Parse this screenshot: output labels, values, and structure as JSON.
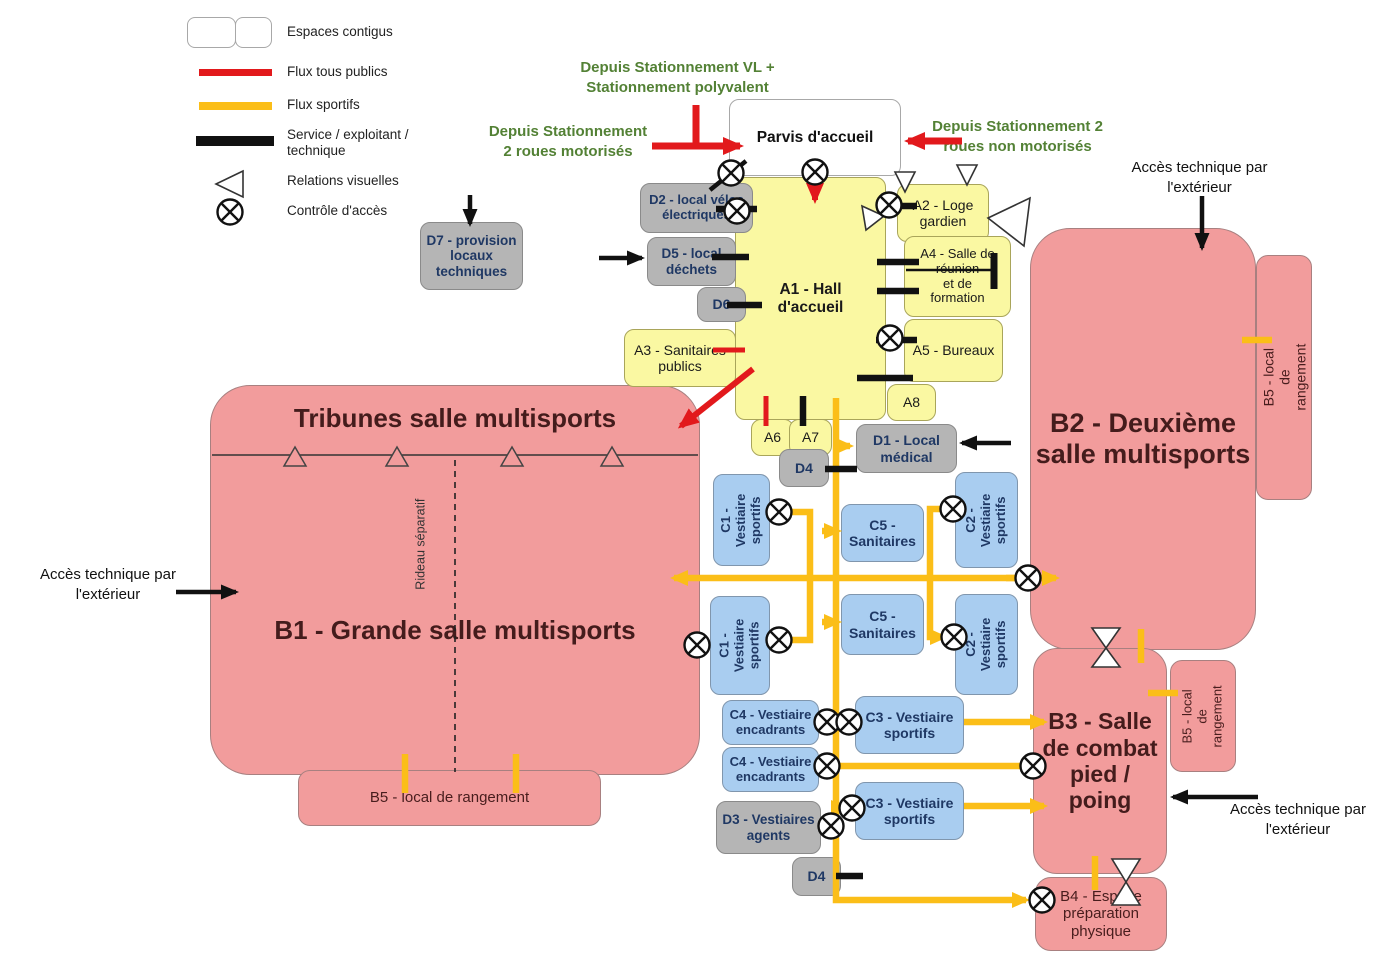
{
  "legend": {
    "espaces_contigus": "Espaces contigus",
    "flux_tous_publics": "Flux tous publics",
    "flux_sportifs": "Flux sportifs",
    "service": "Service / exploitant /\ntechnique",
    "relations_visuelles": "Relations visuelles",
    "controle_acces": "Contrôle d'accès"
  },
  "external_flows": {
    "depuis_vl": "Depuis Stationnement VL +\nStationnement polyvalent",
    "depuis_2r_motorises": "Depuis Stationnement\n2 roues motorisés",
    "depuis_2r_non_motorises": "Depuis Stationnement 2\nroues non motorisés",
    "acces_technique": "Accès technique par\nl'extérieur"
  },
  "annotations": {
    "tribunes": "Tribunes salle multisports",
    "rideau_separatif": "Rideau séparatif"
  },
  "nodes": {
    "parvis": "Parvis d'accueil",
    "a1": "A1 - Hall\nd'accueil",
    "a2": "A2 - Loge\ngardien",
    "a3": "A3 - Sanitaires\npublics",
    "a4": "A4 - Salle de\nréunion\net de\nformation",
    "a5": "A5 - Bureaux",
    "a6": "A6",
    "a7": "A7",
    "a8": "A8",
    "b1": "B1 - Grande salle multisports",
    "b2": "B2 - Deuxième\nsalle multisports",
    "b3": "B3 - Salle\nde combat\npied /\npoing",
    "b4": "B4 - Espace\npréparation\nphysique",
    "b5_b1": "B5 - local de rangement",
    "b5_b2": "B5 - local de rangement",
    "b5_b3": "B5 - local de\nrangement",
    "c1_haut": "C1 - Vestiaire\nsportifs",
    "c1_bas": "C1 - Vestiaire\nsportifs",
    "c2_haut": "C2 - Vestiaire\nsportifs",
    "c2_bas": "C2 - Vestiaire\nsportifs",
    "c3_haut": "C3 - Vestiaire\nsportifs",
    "c3_bas": "C3 - Vestiaire\nsportifs",
    "c4_haut": "C4 - Vestiaire\nencadrants",
    "c4_bas": "C4 - Vestiaire\nencadrants",
    "c5_haut": "C5 -\nSanitaires",
    "c5_bas": "C5 -\nSanitaires",
    "d1": "D1 - Local\nmédical",
    "d2": "D2 - local vélos\nélectriques",
    "d3": "D3 - Vestiaires\nagents",
    "d4_haut": "D4",
    "d4_bas": "D4",
    "d5": "D5 - local\ndéchets",
    "d6": "D6",
    "d7": "D7 - provision locaux\ntechniques"
  },
  "colors": {
    "flux_tous_publics": "#E2191C",
    "flux_sportifs": "#FBBE18",
    "service_technique": "#111111",
    "espaces_accueil": "#FAF8A2",
    "vestiaires": "#A9CDF0",
    "salles_sportives": "#F29C9C",
    "locaux_service": "#B5B5B5",
    "texte_exterieur": "#538135"
  }
}
